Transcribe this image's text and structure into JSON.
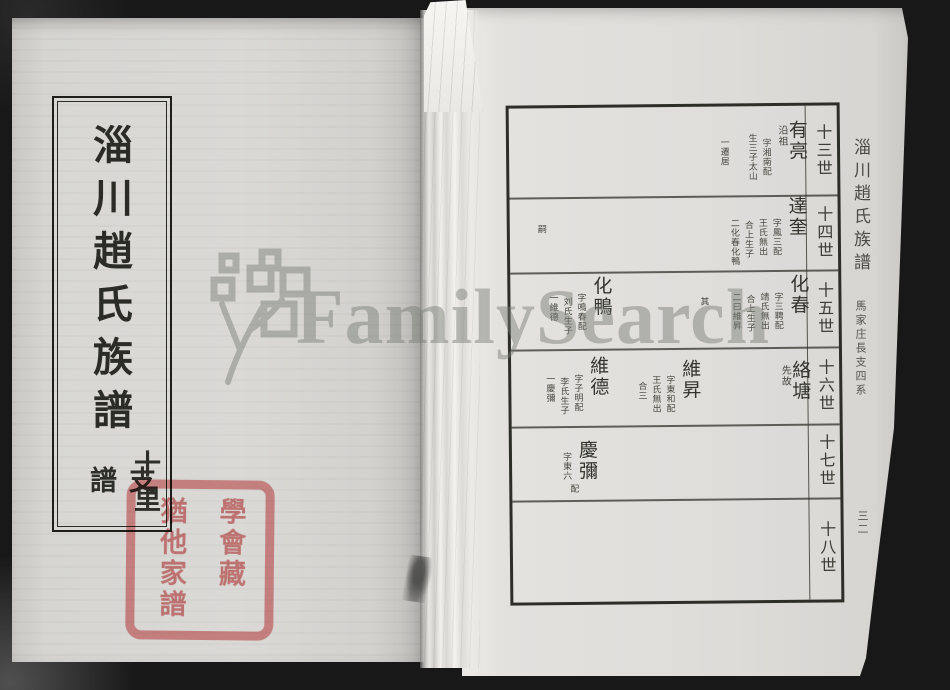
{
  "watermark": {
    "text": "FamilySearch"
  },
  "left_page": {
    "title": "淄川趙氏族譜",
    "subtitle_right": "十里",
    "subtitle_left": "支譜",
    "seal": {
      "col1": "猶他家譜",
      "col2": "學會藏"
    }
  },
  "right_page": {
    "margin_title": "淄川趙氏族譜",
    "margin_subtitle": "馬家庄長支四系",
    "page_number": "三二",
    "seal": {
      "col1": "猶他家譜",
      "col2": "學會藏"
    },
    "generations": [
      "十三世",
      "十四世",
      "十五世",
      "十六世",
      "十七世",
      "十八世"
    ],
    "entries": [
      {
        "generation": "十三世",
        "name": "有亮",
        "sub": "沿祖",
        "annotations": [
          "字湘南配",
          "生三子太山",
          "一遷居"
        ]
      },
      {
        "generation": "十四世",
        "name": "達奎",
        "annotations": [
          "字鳳三配",
          "王氏無出",
          "合上生子",
          "二化春化鴨"
        ],
        "extra": "嗣"
      },
      {
        "generation": "十五世",
        "name": "化春",
        "annotations": [
          "字三聘配",
          "靖氏無出",
          "合上生子",
          "二曰維昇"
        ],
        "extra": "其"
      },
      {
        "generation": "十五世",
        "name": "化鴨",
        "annotations": [
          "字鳴春配",
          "刘氏生子",
          "一維德"
        ]
      },
      {
        "generation": "十六世",
        "name": "絡塘",
        "sub": "先故",
        "annotations": []
      },
      {
        "generation": "十六世",
        "name": "維昇",
        "annotations": [
          "字東和配",
          "王氏無出",
          "合三"
        ]
      },
      {
        "generation": "十六世",
        "name": "維德",
        "annotations": [
          "字子明配",
          "李氏生子",
          "一慶彌"
        ]
      },
      {
        "generation": "十七世",
        "name": "慶彌",
        "annotations": [
          "字東六"
        ],
        "extra": "配"
      }
    ]
  }
}
